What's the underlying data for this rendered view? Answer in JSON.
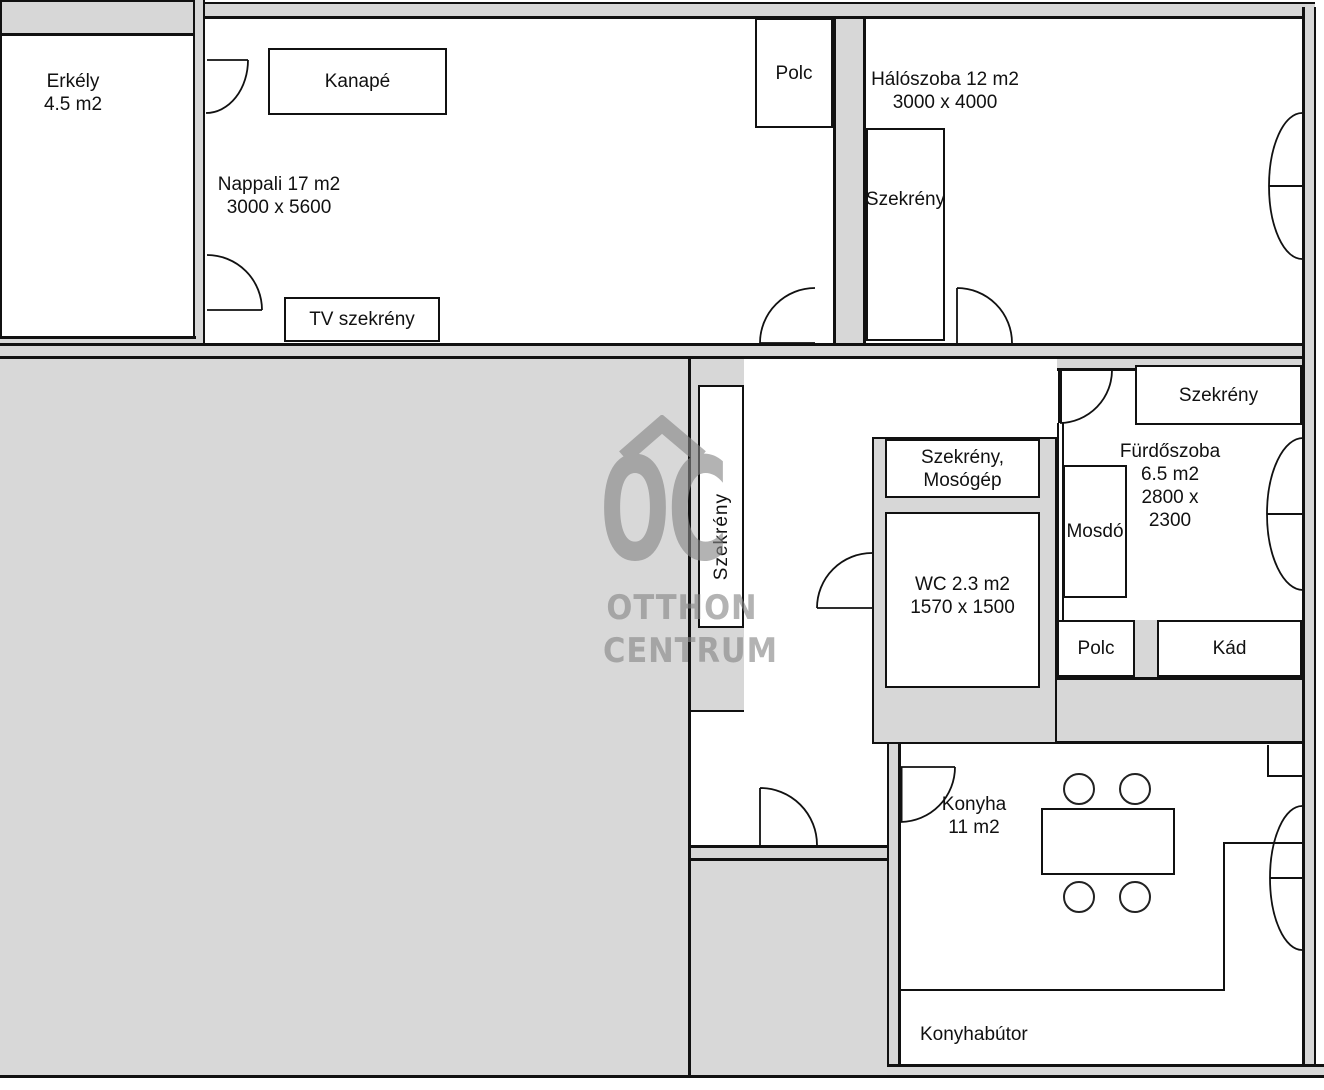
{
  "plan": {
    "balcony": {
      "name": "Erkély",
      "area": "4.5 m2"
    },
    "living": {
      "name": "Nappali 17 m2",
      "dims": "3000 x 5600"
    },
    "bedroom": {
      "name": "Hálószoba 12 m2",
      "dims": "3000 x 4000"
    },
    "bathroom": {
      "name": "Fürdőszoba",
      "area": "6.5 m2",
      "dims_line1": "2800 x",
      "dims_line2": "2300"
    },
    "wc": {
      "name": "WC 2.3 m2",
      "dims": "1570 x 1500"
    },
    "kitchen": {
      "name": "Konyha",
      "area": "11 m2"
    },
    "furniture": {
      "kanape": "Kanapé",
      "tv_szekreny": "TV szekrény",
      "polc_top": "Polc",
      "szekreny_bedroom": "Szekrény",
      "szekreny_hall": "Szekrény",
      "szekreny_mosogep_line1": "Szekrény,",
      "szekreny_mosogep_line2": "Mosógép",
      "szekreny_bathroom": "Szekrény",
      "mosdo": "Mosdó",
      "polc_bathroom": "Polc",
      "kad": "Kád",
      "konyhabutor": "Konyhabútor"
    },
    "watermark": {
      "logo": "OC",
      "line1": "OTTHON",
      "line2": "CENTRUM"
    },
    "colors": {
      "wall_fill": "#d7d7d7",
      "floor_fill": "#d8d8d8",
      "line": "#111111",
      "watermark": "#868686"
    }
  }
}
